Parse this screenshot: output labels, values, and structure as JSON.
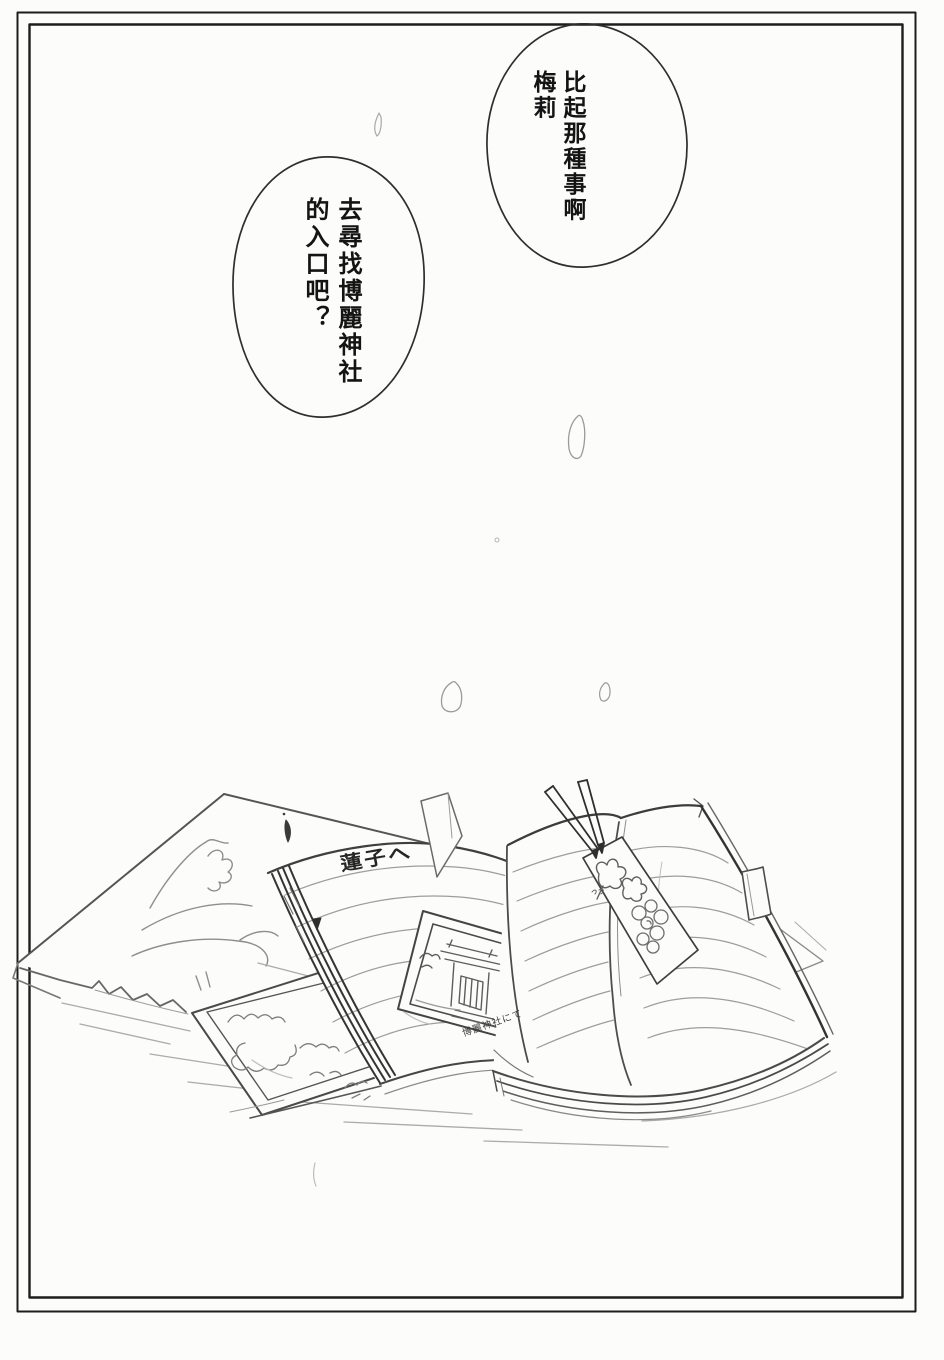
{
  "colors": {
    "paper": "#fcfcfb",
    "ink": "#262626",
    "pencil_gray": "#8a8a8a",
    "frame": "#1d1d1d"
  },
  "bubbles": {
    "top_right": {
      "col1": "比起那種事啊",
      "col2": "梅莉"
    },
    "mid_left": {
      "col1": "去尋找博麗神社",
      "col2": "的入口吧？"
    }
  },
  "handwriting": {
    "notebook_note": "蓮子へ",
    "photo_caption": "博麗神社にて"
  },
  "artwork": {
    "elements": [
      "mountain-photograph-sheet",
      "foliage-photograph",
      "open-notebook-with-dedication",
      "shrine-photograph",
      "open-book",
      "pressed-flower-bookmark",
      "crossed-pencils",
      "ribbon-page-marker",
      "floating-page",
      "falling-petals"
    ]
  }
}
